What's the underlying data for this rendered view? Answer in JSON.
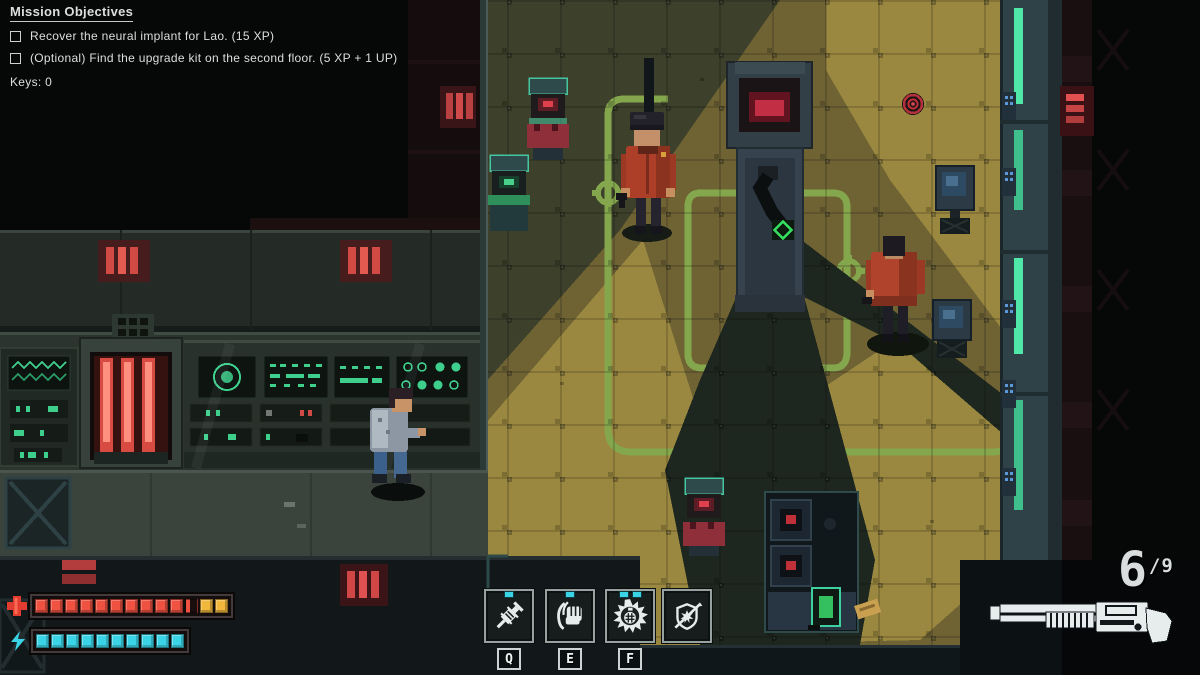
{
  "colors": {
    "hud_text": "#dedede",
    "health_full": "#ef5240",
    "health_bonus": "#f2b83c",
    "energy": "#3bd3e6",
    "path_green": "#84a74d",
    "light_yellow": "#9b8840",
    "alert_red": "#d84848",
    "screen_teal": "#3fd0a0"
  },
  "objectives": {
    "title": "Mission Objectives",
    "items": [
      "Recover the neural implant for Lao. (15 XP)",
      "(Optional) Find the upgrade kit on the second floor. (5 XP + 1 UP)"
    ],
    "keys": "Keys: 0"
  },
  "status": {
    "health": {
      "full": 10,
      "partial": 1,
      "bonus": 2
    },
    "energy": {
      "full": 10
    }
  },
  "abilities": [
    {
      "id": "stim-syringe",
      "icon": "syringe-icon",
      "key": "Q",
      "charges": 1
    },
    {
      "id": "melee-punch",
      "icon": "fist-icon",
      "key": "E",
      "charges": 1
    },
    {
      "id": "grenade",
      "icon": "grenade-burst-icon",
      "key": "F",
      "charges": 2
    },
    {
      "id": "shield-pierce",
      "icon": "shield-break-icon",
      "key": "",
      "charges": 0
    }
  ],
  "ammo": {
    "current": "6",
    "separator": "/",
    "max": "9",
    "weapon": "shotgun"
  },
  "scene": {
    "entities": [
      {
        "name": "guard-north",
        "jacket": "#ad3f28"
      },
      {
        "name": "guard-east",
        "jacket": "#b0432b"
      },
      {
        "name": "player-character",
        "jacket": "#8d97a3"
      },
      {
        "name": "objective-marker",
        "color": "#c23038"
      },
      {
        "name": "server-column-robot-arm"
      },
      {
        "name": "patrol-path-green-circuit"
      }
    ]
  }
}
